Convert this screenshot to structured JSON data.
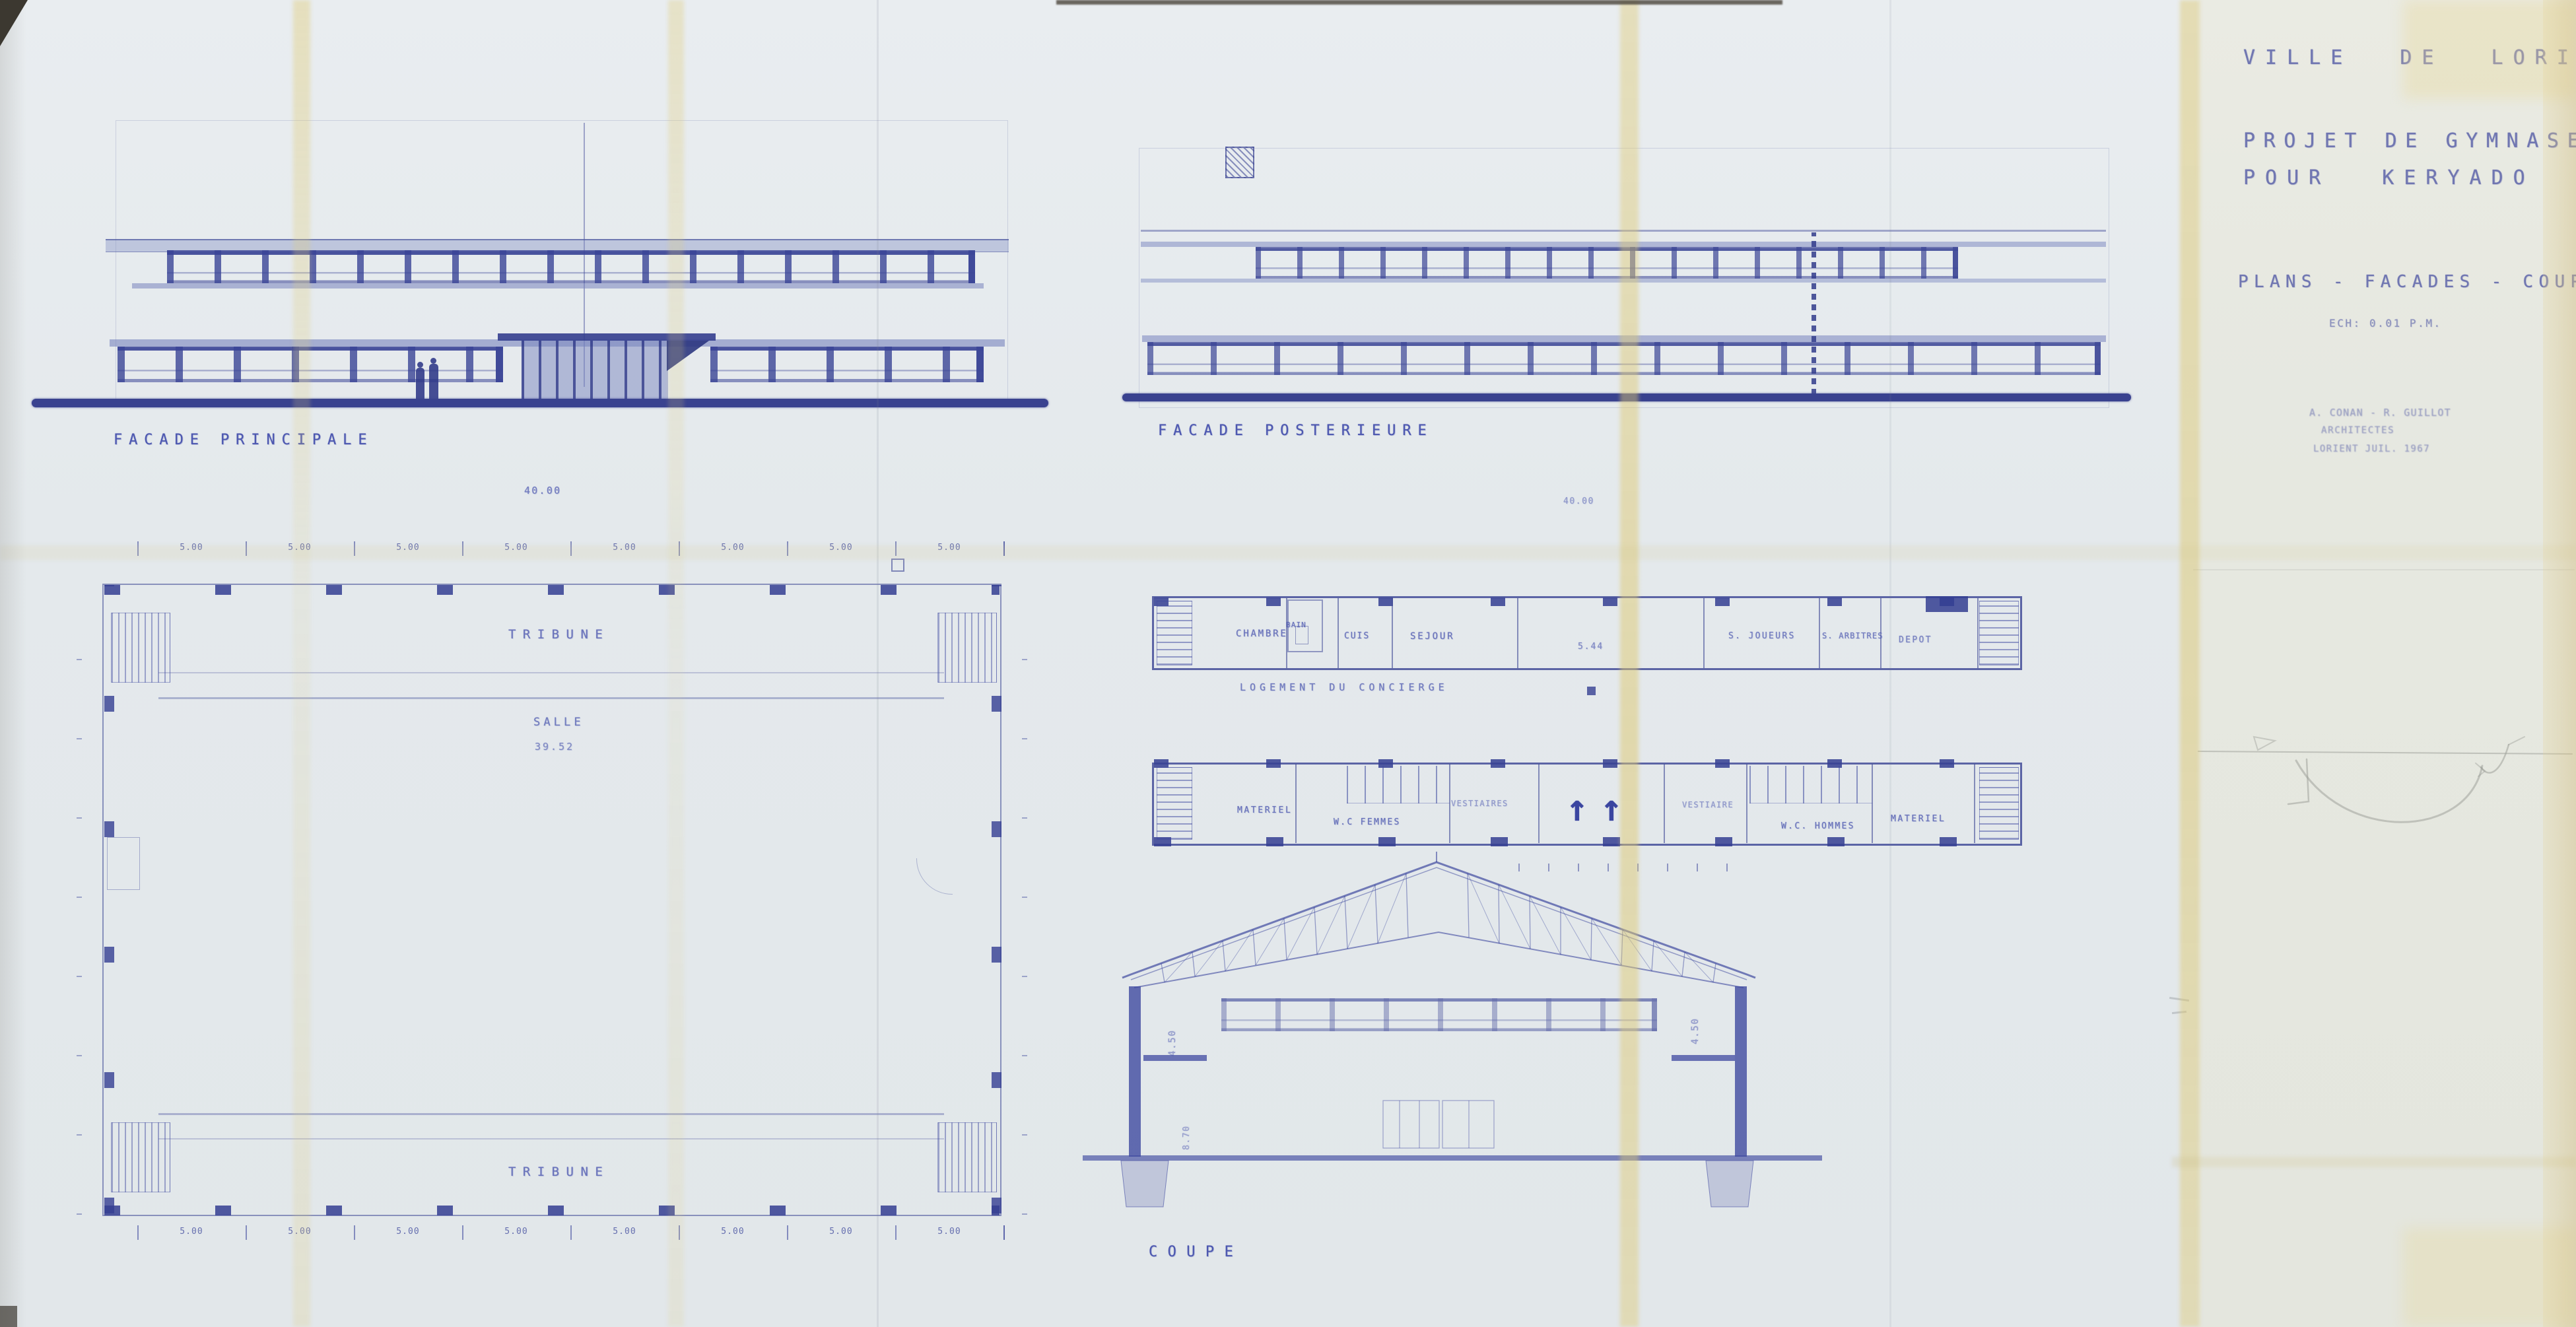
{
  "sheet": {
    "title_block": {
      "city": "VILLE DE LORIENT",
      "project_line1": "PROJET DE GYMNASE",
      "project_line2": "POUR KERYADO",
      "sheet_title": "PLANS - FACADES - COUPE",
      "scale_note": "ECH: 0.01 P.M.",
      "architect_line1": "A. CONAN - R. GUILLOT",
      "architect_line2": "ARCHITECTES",
      "architect_line3": "LORIENT JUIL. 1967"
    },
    "facade_principale": {
      "label": "FACADE PRINCIPALE",
      "overall_dim": "40.00"
    },
    "facade_posterieure": {
      "label": "FACADE POSTERIEURE",
      "overall_dim": "40.00"
    },
    "plan_salle": {
      "tribune_top": "TRIBUNE",
      "tribune_bottom": "TRIBUNE",
      "room": "SALLE",
      "room_dim": "39.52",
      "bay_dim": "5.00"
    },
    "plan_annexe": {
      "logement_label": "LOGEMENT DU CONCIERGE",
      "rooms_logement": [
        "CHAMBRE",
        "BAIN",
        "CUIS",
        "SEJOUR"
      ],
      "open_area_dim": "5.44",
      "rooms_etage": [
        "S. JOUEURS",
        "S. ARBITRES",
        "DEPOT"
      ],
      "rooms_rdc": [
        "MATERIEL",
        "W.C FEMMES",
        "VESTIAIRES",
        "VESTIAIRE",
        "W.C. HOMMES",
        "MATERIEL"
      ]
    },
    "coupe": {
      "label": "COUPE",
      "dim_left": "4.50",
      "dim_right": "4.50",
      "dim_height": "8.70"
    },
    "icons": {
      "stair_arrow": "↑"
    },
    "colors": {
      "ink": "#4752a6",
      "ink_dark": "#343e92",
      "paper": "#e5eaed",
      "fold_stain": "#e3d49c",
      "pencil": "#8f959b"
    }
  }
}
